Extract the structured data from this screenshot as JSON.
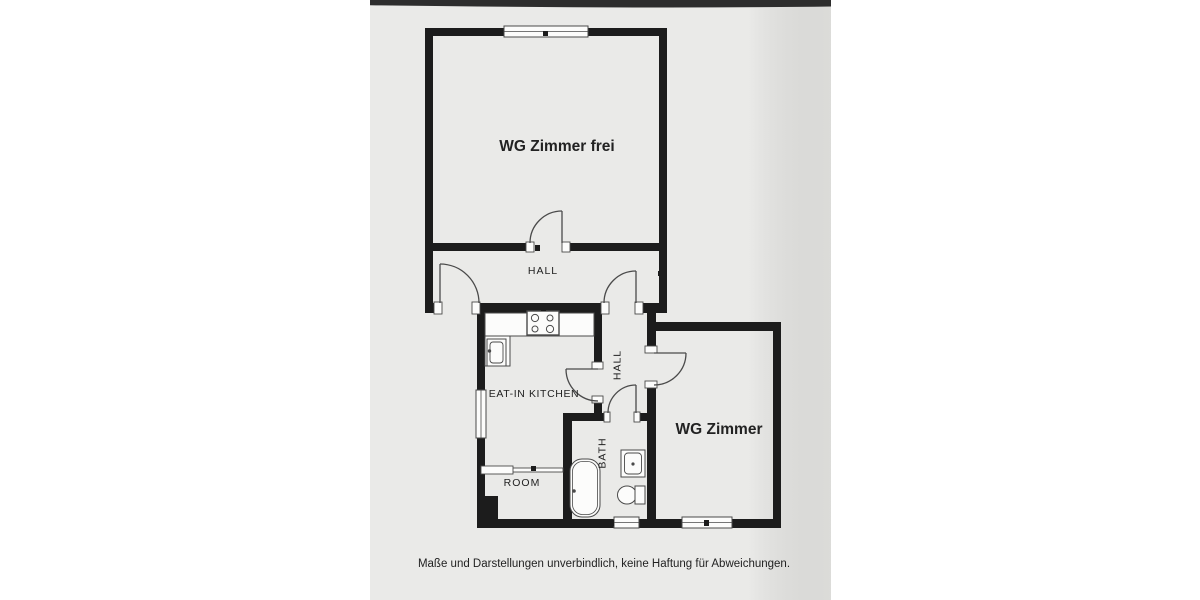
{
  "floorplan": {
    "rooms": {
      "room_free": {
        "label": "WG Zimmer frei"
      },
      "hall_main": {
        "label": "HALL"
      },
      "kitchen": {
        "label": "EAT-IN KITCHEN"
      },
      "hall_side": {
        "label": "HALL"
      },
      "bath": {
        "label": "BATH"
      },
      "room_small": {
        "label": "ROOM"
      },
      "room_right": {
        "label": "WG Zimmer"
      }
    },
    "fixtures": {
      "stove": "stove-4-burners",
      "kitchen_sink": "kitchen-sink",
      "bathtub": "bathtub",
      "bath_sink": "washbasin",
      "toilet": "toilet"
    },
    "footer": {
      "disclaimer": "Maße und Darstellungen unverbindlich, keine Haftung für Abweichungen."
    },
    "colors": {
      "page": "#ffffff",
      "paper": "#eaeae8",
      "scan_bar": "#2d2d2d",
      "wall": "#1c1c1c",
      "line": "#4a4a4a",
      "text": "#222222"
    }
  }
}
